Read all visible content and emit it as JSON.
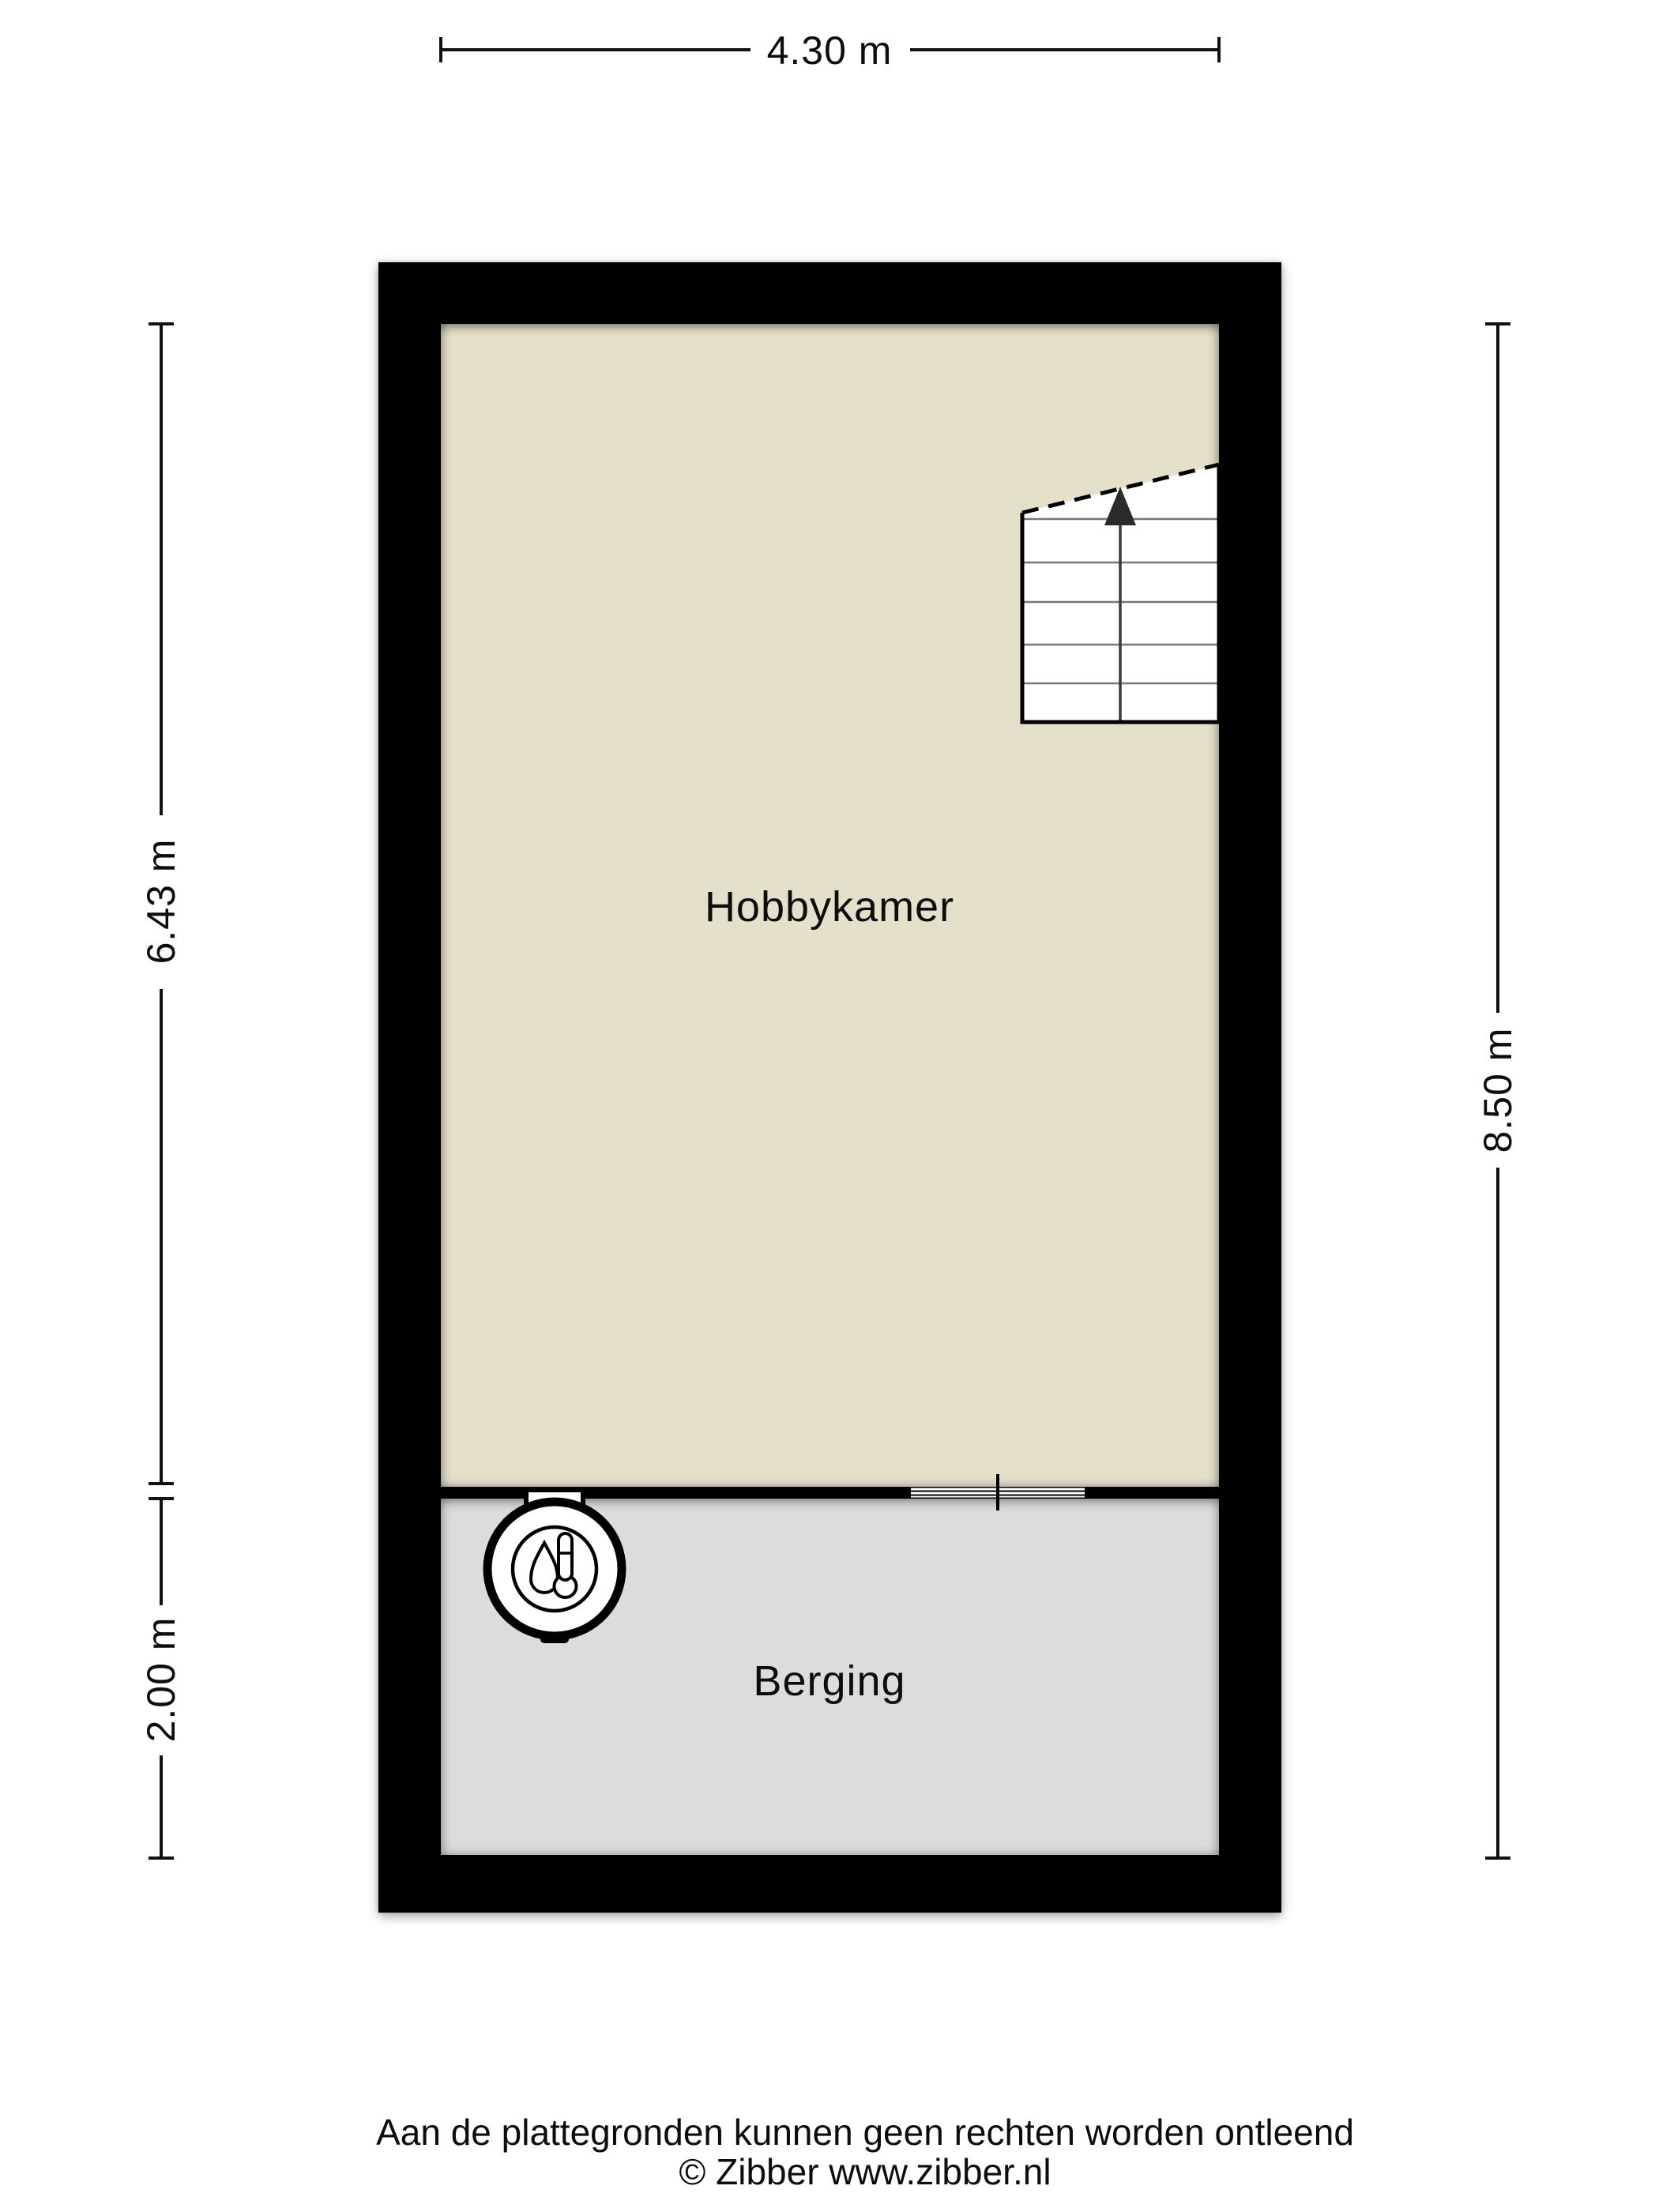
{
  "title": "Floor plan",
  "dimensions": {
    "top": {
      "label": "4.30 m"
    },
    "left_upper": {
      "label": "6.43 m"
    },
    "left_lower": {
      "label": "2.00 m"
    },
    "right": {
      "label": "8.50 m"
    }
  },
  "rooms": [
    {
      "name": "Hobbykamer",
      "floor_color": "#e5e0ca"
    },
    {
      "name": "Berging",
      "floor_color": "#dcdcdc"
    }
  ],
  "symbols": {
    "stairs": "staircase-with-up-arrow",
    "boiler": "boiler-water-heater-icon",
    "interior_window": "window-in-divider-wall"
  },
  "colors": {
    "wall": "#000000",
    "hobby_floor": "#e5e0ca",
    "berging_floor": "#dcdcdc",
    "background": "#ffffff",
    "stair_steps": "#777777"
  },
  "footer": {
    "disclaimer": "Aan de plattegronden kunnen geen rechten worden ontleend",
    "copyright": "© Zibber www.zibber.nl"
  }
}
